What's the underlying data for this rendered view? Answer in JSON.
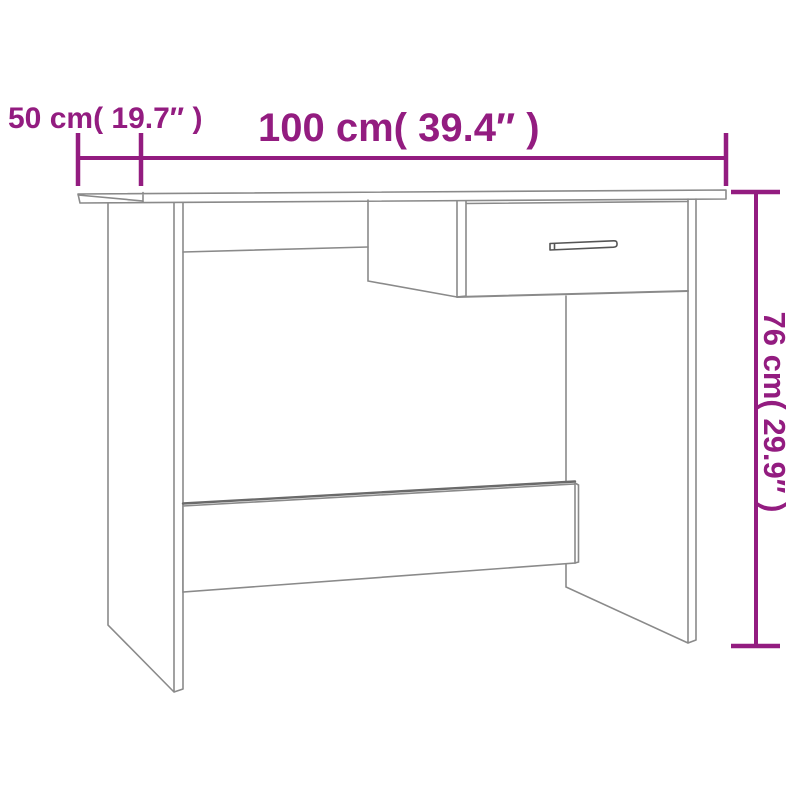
{
  "colors": {
    "accent": "#931c80",
    "line": "#8a8a8a",
    "line_dark": "#6a6a6a",
    "handle": "#555555",
    "background": "#ffffff"
  },
  "labels": {
    "depth": "50 cm( 19.7″ )",
    "width": "100 cm( 39.4″ )",
    "height": "76 cm( 29.9″ )"
  },
  "dimensions": {
    "depth_cm": "50",
    "depth_inches": "19.7",
    "width_cm": "100",
    "width_inches": "39.4",
    "height_cm": "76",
    "height_inches": "29.9"
  }
}
